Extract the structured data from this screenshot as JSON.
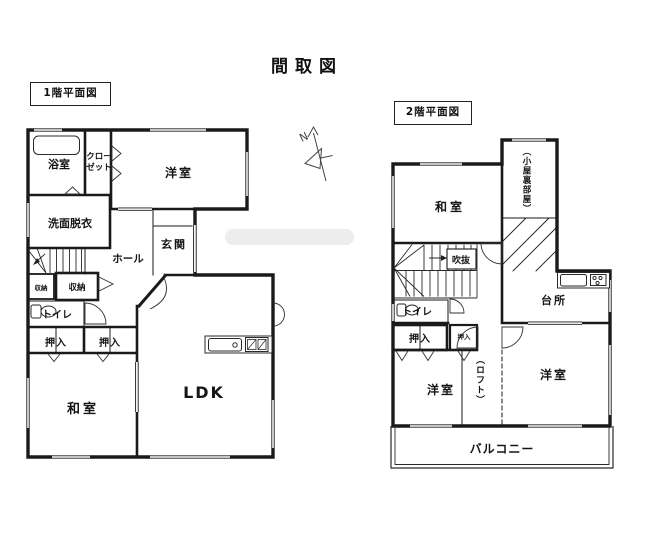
{
  "title": "間取図",
  "compass": {
    "label": "N"
  },
  "colors": {
    "line": "#1a1a1a",
    "watermark": "#ededed",
    "background": "#ffffff"
  },
  "floor1": {
    "title": "1階平面図",
    "rooms": {
      "bath": "浴室",
      "closet_line1": "クロー",
      "closet_line2": "ゼット",
      "washroom": "洗面脱衣",
      "western_room": "洋室",
      "entrance": "玄関",
      "hall": "ホール",
      "storage_small": "収納",
      "storage": "収納",
      "toilet": "トイレ",
      "oshiire_left": "押入",
      "oshiire_right": "押入",
      "japanese_room": "和室",
      "ldk": "LDK"
    }
  },
  "floor2": {
    "title": "2階平面図",
    "rooms": {
      "japanese_room": "和室",
      "attic": "（小屋裏部屋）",
      "void": "吹抜",
      "toilet": "トイレ",
      "oshiire_left": "押入",
      "oshiire_small": "押入",
      "kitchen": "台所",
      "western_room_left": "洋室",
      "loft": "（ロフト）",
      "western_room_right": "洋室",
      "balcony": "バルコニー"
    }
  }
}
